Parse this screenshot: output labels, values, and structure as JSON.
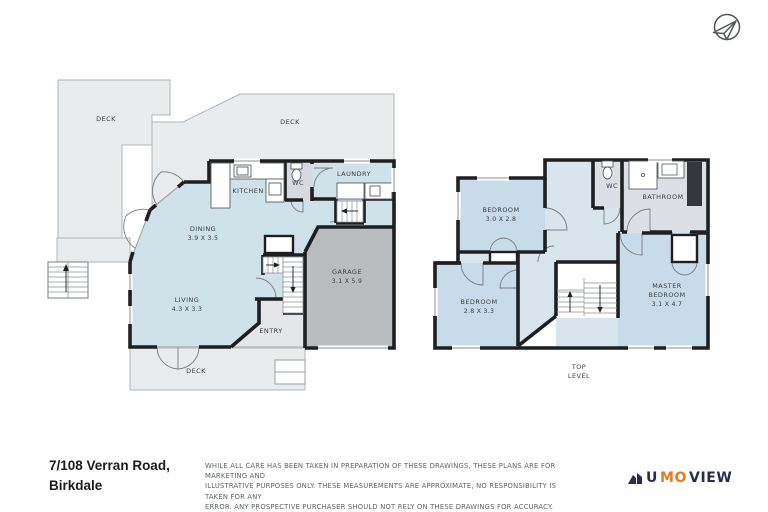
{
  "plans": {
    "ground": {
      "deck_top_left": "DECK",
      "deck_top": "DECK",
      "kitchen": "KITCHEN",
      "wc": "WC",
      "laundry": "LAUNDRY",
      "dining": {
        "name": "DINING",
        "dims": "3.9 X 3.5"
      },
      "garage": {
        "name": "GARAGE",
        "dims": "3.1 X 5.9"
      },
      "living": {
        "name": "LIVING",
        "dims": "4.3 X 3.3"
      },
      "entry": "ENTRY",
      "deck_bottom": "DECK"
    },
    "top_level": {
      "bedroom1": {
        "name": "BEDROOM",
        "dims": "3.0 X 2.8"
      },
      "wc": "WC",
      "bathroom": "BATHROOM",
      "master": {
        "line1": "MASTER",
        "line2": "BEDROOM",
        "dims": "3.1 X 4.7"
      },
      "bedroom2": {
        "name": "BEDROOM",
        "dims": "2.8 X 3.3"
      },
      "level_label": {
        "line1": "TOP",
        "line2": "LEVEL"
      }
    }
  },
  "footer": {
    "address_line1": "7/108 Verran Road,",
    "address_line2": "Birkdale",
    "disclaimer_lines": [
      "WHILE ALL CARE HAS BEEN TAKEN IN PREPARATION OF THESE DRAWINGS, THESE PLANS ARE FOR MARKETING AND",
      "ILLUSTRATIVE PURPOSES ONLY. THESE MEASUREMENTS ARE APPROXIMATE, NO RESPONSIBILITY IS TAKEN FOR ANY",
      "ERROR. ANY PROSPECTIVE PURCHASER SHOULD NOT RELY ON THESE DRAWINGS FOR ACCURACY.",
      "ALL RIGHTS RESERVED"
    ],
    "logo": {
      "u": "U",
      "mo": "MO",
      "view": "VIEW"
    }
  },
  "colors": {
    "wall": "#1e1f21",
    "room_blue": "#cfe1e9",
    "hall_blue": "#d8e5ec",
    "bedroom_blue": "#c8dbe8",
    "deck_gray": "#eaebed",
    "garage_gray": "#b9bdc0",
    "bath_gray": "#dce0e4",
    "logo_navy": "#262e4e",
    "logo_orange": "#e8791d"
  }
}
